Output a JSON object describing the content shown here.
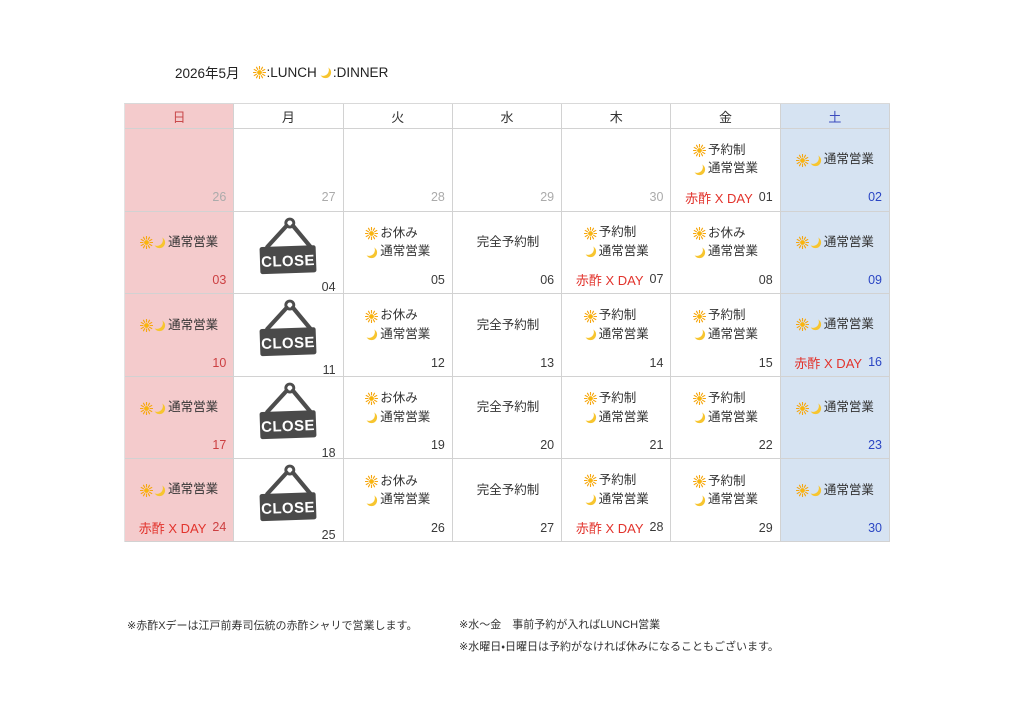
{
  "title": {
    "month": "2026年5月",
    "lunch": ":LUNCH",
    "dinner": ":DINNER"
  },
  "labels": {
    "akazu": "赤酢 X DAY",
    "close": "CLOSE"
  },
  "calendar": {
    "weekdays": [
      "日",
      "月",
      "火",
      "水",
      "木",
      "金",
      "土"
    ],
    "cells": [
      {
        "day": "26",
        "tone": "muted"
      },
      {
        "day": "27",
        "tone": "muted"
      },
      {
        "day": "28",
        "tone": "muted"
      },
      {
        "day": "29",
        "tone": "muted"
      },
      {
        "day": "30",
        "tone": "muted"
      },
      {
        "day": "01",
        "tone": "normal",
        "lines": [
          {
            "icons": [
              "sun"
            ],
            "text": "予約制"
          },
          {
            "icons": [
              "moon"
            ],
            "text": "通常営業"
          }
        ],
        "badge": true
      },
      {
        "day": "02",
        "tone": "blue",
        "lines": [
          {
            "icons": [
              "sun",
              "moon"
            ],
            "text": "通常営業"
          }
        ]
      },
      {
        "day": "03",
        "tone": "red",
        "lines": [
          {
            "icons": [
              "sun",
              "moon"
            ],
            "text": "通常営業"
          }
        ]
      },
      {
        "day": "04",
        "tone": "normal",
        "type": "close"
      },
      {
        "day": "05",
        "tone": "normal",
        "lines": [
          {
            "icons": [
              "sun"
            ],
            "text": "お休み"
          },
          {
            "icons": [
              "moon"
            ],
            "text": "通常営業"
          }
        ]
      },
      {
        "day": "06",
        "tone": "normal",
        "lines": [
          {
            "icons": [],
            "text": "完全予約制"
          }
        ]
      },
      {
        "day": "07",
        "tone": "normal",
        "lines": [
          {
            "icons": [
              "sun"
            ],
            "text": "予約制"
          },
          {
            "icons": [
              "moon"
            ],
            "text": "通常営業"
          }
        ],
        "badge": true
      },
      {
        "day": "08",
        "tone": "normal",
        "lines": [
          {
            "icons": [
              "sun"
            ],
            "text": "お休み"
          },
          {
            "icons": [
              "moon"
            ],
            "text": "通常営業"
          }
        ]
      },
      {
        "day": "09",
        "tone": "blue",
        "lines": [
          {
            "icons": [
              "sun",
              "moon"
            ],
            "text": "通常営業"
          }
        ]
      },
      {
        "day": "10",
        "tone": "red",
        "lines": [
          {
            "icons": [
              "sun",
              "moon"
            ],
            "text": "通常営業"
          }
        ]
      },
      {
        "day": "11",
        "tone": "normal",
        "type": "close"
      },
      {
        "day": "12",
        "tone": "normal",
        "lines": [
          {
            "icons": [
              "sun"
            ],
            "text": "お休み"
          },
          {
            "icons": [
              "moon"
            ],
            "text": "通常営業"
          }
        ]
      },
      {
        "day": "13",
        "tone": "normal",
        "lines": [
          {
            "icons": [],
            "text": "完全予約制"
          }
        ]
      },
      {
        "day": "14",
        "tone": "normal",
        "lines": [
          {
            "icons": [
              "sun"
            ],
            "text": "予約制"
          },
          {
            "icons": [
              "moon"
            ],
            "text": "通常営業"
          }
        ]
      },
      {
        "day": "15",
        "tone": "normal",
        "lines": [
          {
            "icons": [
              "sun"
            ],
            "text": "予約制"
          },
          {
            "icons": [
              "moon"
            ],
            "text": "通常営業"
          }
        ]
      },
      {
        "day": "16",
        "tone": "blue",
        "lines": [
          {
            "icons": [
              "sun",
              "moon"
            ],
            "text": "通常営業"
          }
        ],
        "badge": true
      },
      {
        "day": "17",
        "tone": "red",
        "lines": [
          {
            "icons": [
              "sun",
              "moon"
            ],
            "text": "通常営業"
          }
        ]
      },
      {
        "day": "18",
        "tone": "normal",
        "type": "close"
      },
      {
        "day": "19",
        "tone": "normal",
        "lines": [
          {
            "icons": [
              "sun"
            ],
            "text": "お休み"
          },
          {
            "icons": [
              "moon"
            ],
            "text": "通常営業"
          }
        ]
      },
      {
        "day": "20",
        "tone": "normal",
        "lines": [
          {
            "icons": [],
            "text": "完全予約制"
          }
        ]
      },
      {
        "day": "21",
        "tone": "normal",
        "lines": [
          {
            "icons": [
              "sun"
            ],
            "text": "予約制"
          },
          {
            "icons": [
              "moon"
            ],
            "text": "通常営業"
          }
        ]
      },
      {
        "day": "22",
        "tone": "normal",
        "lines": [
          {
            "icons": [
              "sun"
            ],
            "text": "予約制"
          },
          {
            "icons": [
              "moon"
            ],
            "text": "通常営業"
          }
        ]
      },
      {
        "day": "23",
        "tone": "blue",
        "lines": [
          {
            "icons": [
              "sun",
              "moon"
            ],
            "text": "通常営業"
          }
        ]
      },
      {
        "day": "24",
        "tone": "red",
        "lines": [
          {
            "icons": [
              "sun",
              "moon"
            ],
            "text": "通常営業"
          }
        ],
        "badge": true
      },
      {
        "day": "25",
        "tone": "normal",
        "type": "close"
      },
      {
        "day": "26",
        "tone": "normal",
        "lines": [
          {
            "icons": [
              "sun"
            ],
            "text": "お休み"
          },
          {
            "icons": [
              "moon"
            ],
            "text": "通常営業"
          }
        ]
      },
      {
        "day": "27",
        "tone": "normal",
        "lines": [
          {
            "icons": [],
            "text": "完全予約制"
          }
        ]
      },
      {
        "day": "28",
        "tone": "normal",
        "lines": [
          {
            "icons": [
              "sun"
            ],
            "text": "予約制"
          },
          {
            "icons": [
              "moon"
            ],
            "text": "通常営業"
          }
        ],
        "badge": true
      },
      {
        "day": "29",
        "tone": "normal",
        "lines": [
          {
            "icons": [
              "sun"
            ],
            "text": "予約制"
          },
          {
            "icons": [
              "moon"
            ],
            "text": "通常営業"
          }
        ]
      },
      {
        "day": "30",
        "tone": "blue",
        "lines": [
          {
            "icons": [
              "sun",
              "moon"
            ],
            "text": "通常営業"
          }
        ]
      }
    ]
  },
  "notes": {
    "akazu_note": "※赤酢Xデーは江戸前寿司伝統の赤酢シャリで営業します。",
    "lunch_note": "※水〜金　事前予約が入ればLUNCH営業",
    "holiday_note": "※水曜日・日曜日は予約がなければ休みになることもございます。"
  },
  "colors": {
    "sunday_bg": "#F4CBCC",
    "saturday_bg": "#D6E3F2",
    "sunday_red": "#CC3F41",
    "saturday_blue": "#2B46C4",
    "akazu_red": "#E2332C",
    "muted_gray": "#ABABAB",
    "close_sign": "#4A4A4A",
    "sun_icon": "#F6A60F",
    "moon_icon": "#F7C52F"
  }
}
